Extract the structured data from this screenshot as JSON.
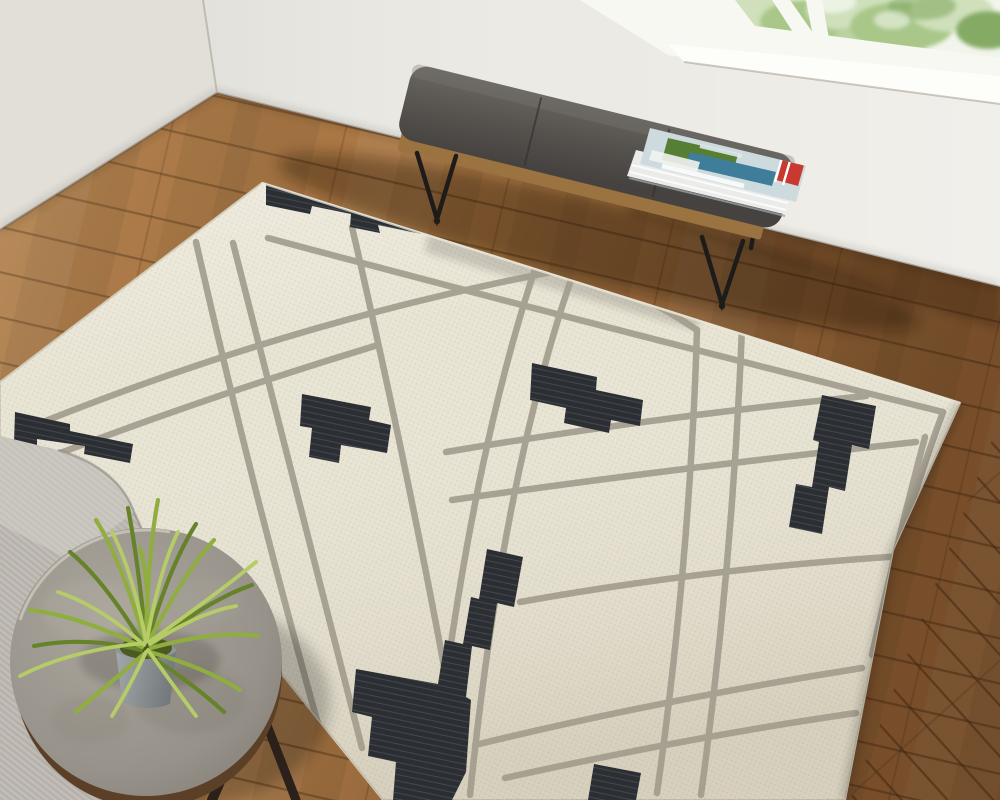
{
  "scene": {
    "description": "Overhead view of a room corner: an abstract cream wool rug with black geometric blocks and taupe map-like lines on a honey wood plank floor, a gray leather bench with hairpin legs and magazines under a bright window with greenery, a gray fabric chair corner and a round concrete side table with a spiky green plant",
    "objects": [
      "area-rug",
      "wood-floor",
      "left-wall",
      "back-wall",
      "window",
      "window-foliage",
      "bench",
      "bench-cushion",
      "bench-wood-frame",
      "hairpin-legs",
      "magazine-stack",
      "accent-chair",
      "side-table",
      "table-legs",
      "potted-plant",
      "plant-pot"
    ]
  },
  "colors": {
    "wall_left": "#e2dfd8",
    "wall_back": "#eceae4",
    "window_frame": "#f8f8f3",
    "sill": "#fdfdfa",
    "sky": "#f2f5ec",
    "foliage_light": "#cfe0ba",
    "foliage_mid": "#a8c788",
    "foliage_dark": "#84aa64",
    "floor_base": "#ad7740",
    "plank_line": "#5f3d1e",
    "rug_base": "#e8e4d4",
    "rug_line": "#a29d8e",
    "rug_black": "#2b2e33",
    "bench_wood": "#9a7341",
    "leg_black": "#1d1c1b",
    "chair_fabric": "#bcb7b1",
    "table_top": "#9d988e",
    "table_rim": "#5b4027",
    "table_leg": "#2b211a",
    "pot": "#8f9597",
    "plant_dark": "#66832a",
    "plant_mid": "#8fae3f",
    "plant_light": "#b5cc67",
    "mag_pages": "#ebecea",
    "mag_cover": "#cddade",
    "mag_navy": "#223d5e",
    "mag_green": "#567f35",
    "mag_teal": "#3e7e9b",
    "mag_red": "#c8392f"
  }
}
